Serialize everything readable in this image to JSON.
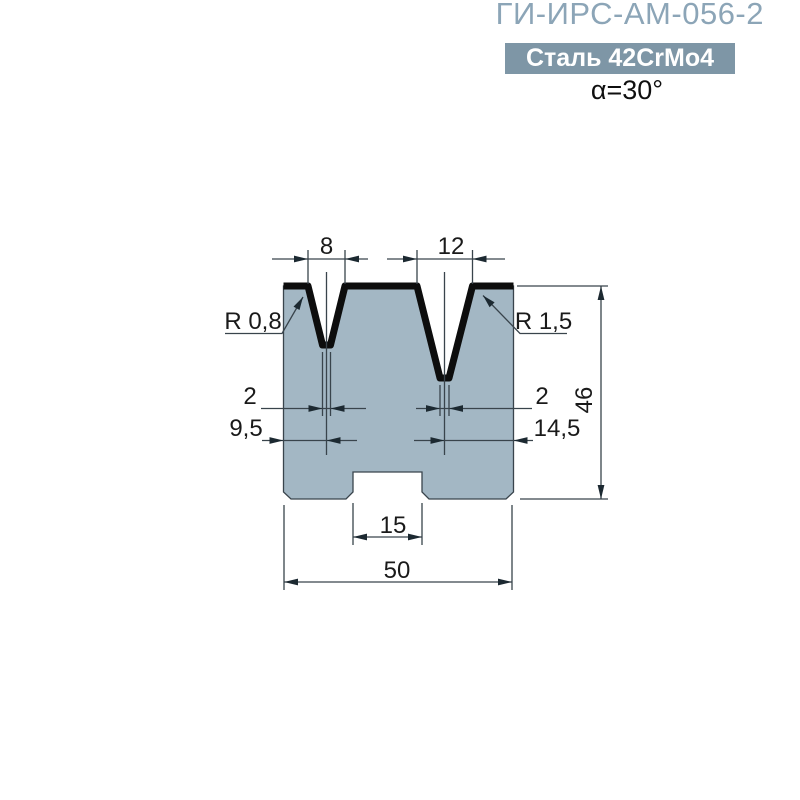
{
  "header": {
    "title": "ГИ-ИРС-АМ-056-2",
    "material": "Сталь 42CrMo4",
    "angle": "α=30°"
  },
  "drawing": {
    "dims": {
      "v1_width": "8",
      "v2_width": "12",
      "v1_radius": "R 0,8",
      "v2_radius": "R 1,5",
      "v1_bottom": "2",
      "v2_bottom": "2",
      "v1_center_from_left": "9,5",
      "v2_center_from_right": "14,5",
      "height": "46",
      "base_slot_width": "15",
      "overall_width": "50"
    },
    "colors": {
      "body_fill": "#a3b7c4",
      "profile_line": "#0d0d0d",
      "dim_line": "#39444c",
      "title_text": "#8ca5b7",
      "badge_bg": "#7e96a6",
      "badge_text": "#ffffff"
    }
  }
}
